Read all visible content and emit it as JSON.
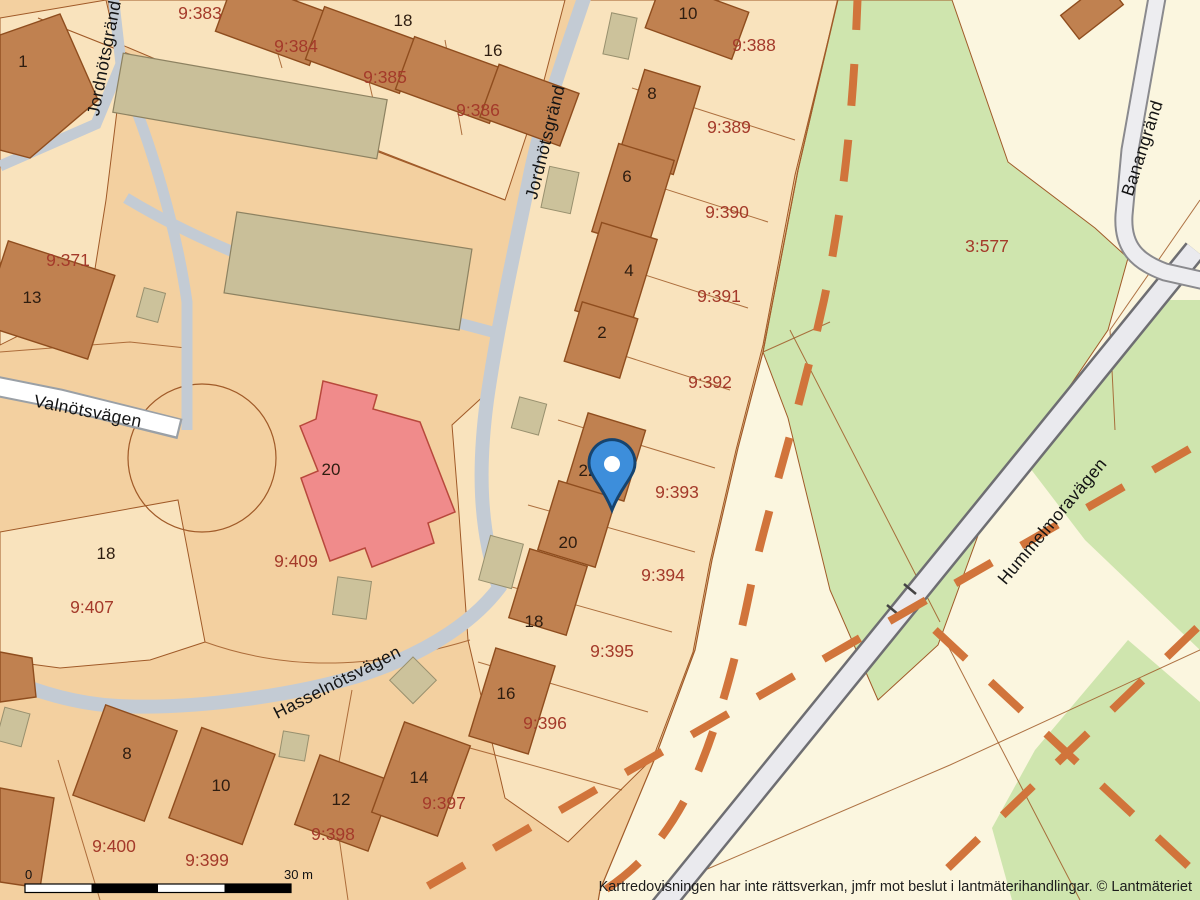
{
  "map_type": "cadastral-parcel-map",
  "parcel_labels": [
    "9:383",
    "9:384",
    "9:385",
    "9:386",
    "9:371",
    "9:388",
    "9:389",
    "9:390",
    "9:391",
    "9:392",
    "9:393",
    "9:394",
    "9:395",
    "9:396",
    "9:397",
    "9:398",
    "9:399",
    "9:400",
    "9:407",
    "9:409",
    "3:577"
  ],
  "house_numbers": [
    "1",
    "18",
    "16",
    "13",
    "10",
    "8",
    "6",
    "4",
    "2",
    "22",
    "20",
    "18",
    "16",
    "20",
    "18",
    "8",
    "10",
    "12",
    "14"
  ],
  "street_labels": [
    "Jordnötsgränd",
    "Jordnötsgränd",
    "Valnötsvägen",
    "Hasselnötsvägen",
    "Hummelmoravägen",
    "Banangränd"
  ],
  "scale_bar": {
    "start": "0",
    "end": "30 m"
  },
  "attribution": "Kartredovisningen har inte rättsverkan, jmfr mot beslut i lantmäterihandlingar. © Lantmäteriet",
  "marker": {
    "name": "location-pin",
    "color": "#3d8edb",
    "outline": "#16446f",
    "center": "#ffffff"
  },
  "colors": {
    "background_cream": "#fbf6df",
    "residential_tan": "#f3d0a0",
    "parcel_light": "#f9e3bd",
    "green_area": "#cfe5ae",
    "building_brown": "#c08150",
    "building_border": "#8f4d1e",
    "building_khaki": "#c9bf99",
    "building_pink": "#f08b8b",
    "road_gray": "#c3cbd4",
    "road_white": "#ffffff",
    "highway_fill": "#eaeaee",
    "highway_border": "#6e6e72",
    "trail_dashed_orange": "#d1743b",
    "parcel_line_brown": "#a05a28",
    "label_red": "#a43a2a",
    "label_dark": "#2e1d10"
  }
}
